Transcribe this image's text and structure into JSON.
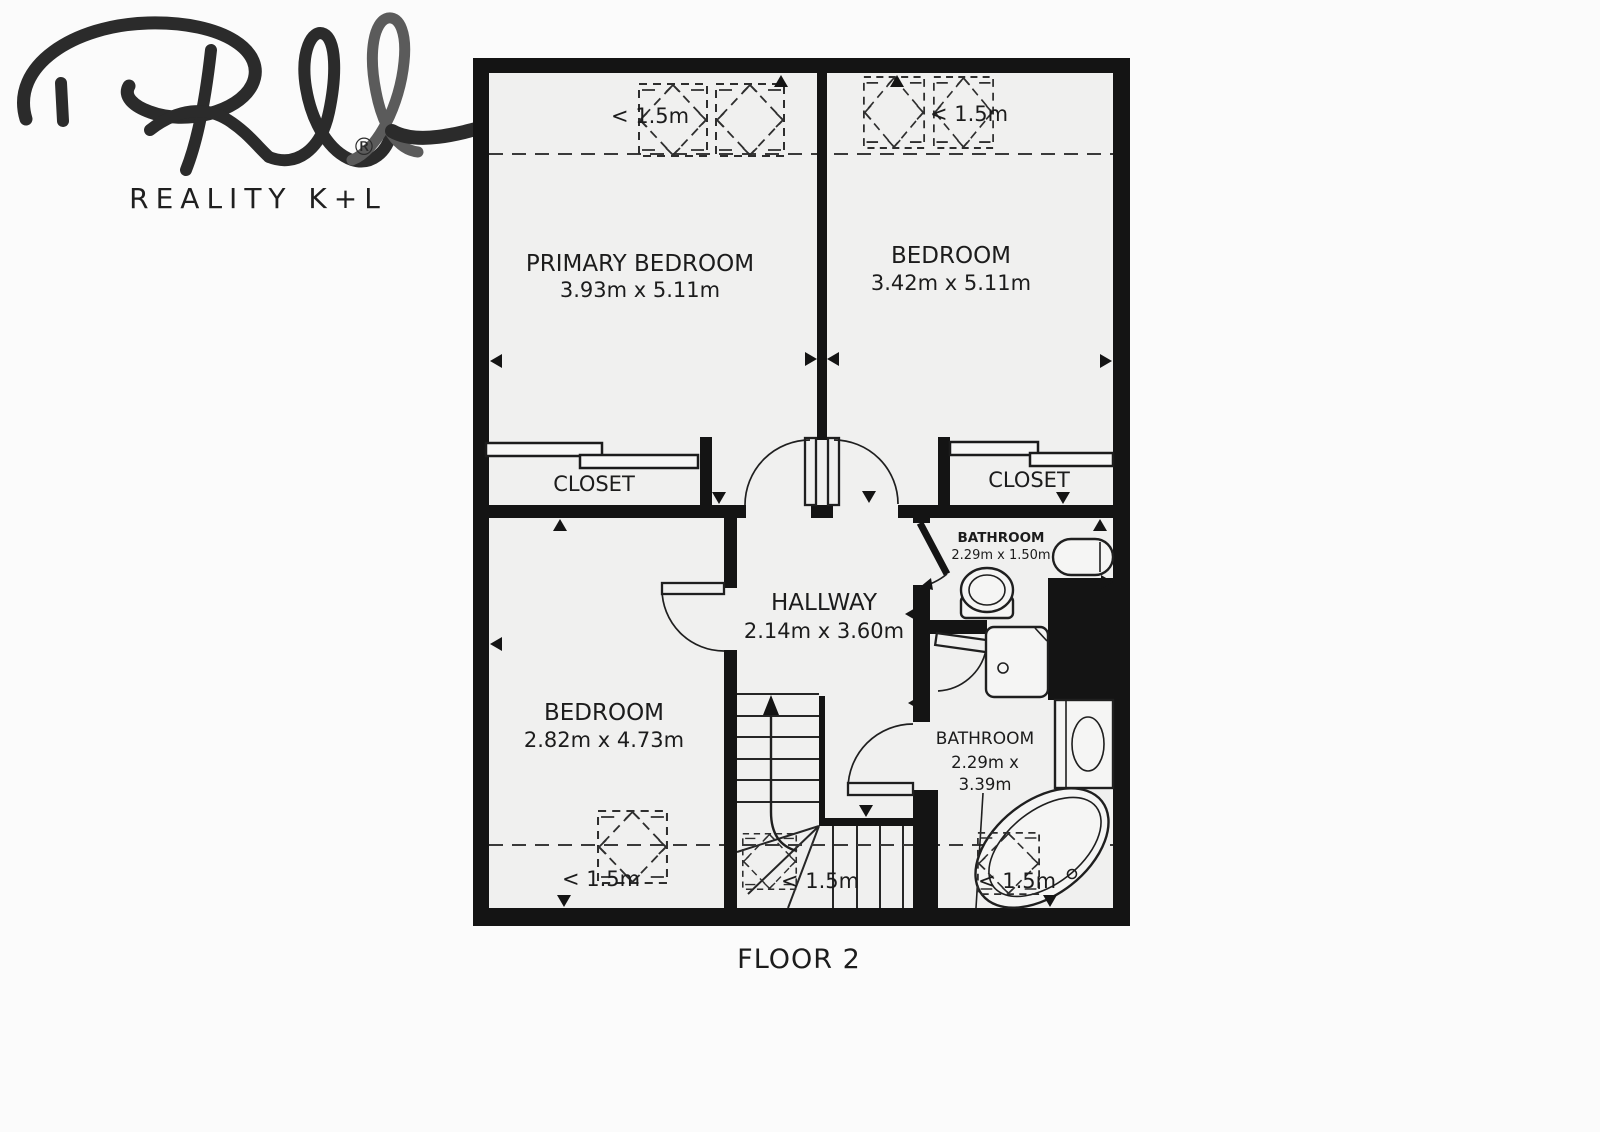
{
  "logo": {
    "brand": "REALITY K+L",
    "registered": "®"
  },
  "plan": {
    "floor_label": "FLOOR 2",
    "low_ceiling": "< 1.5m"
  },
  "rooms": {
    "primary_bedroom": {
      "name": "PRIMARY BEDROOM",
      "dims": "3.93m x 5.11m"
    },
    "bedroom_top": {
      "name": "BEDROOM",
      "dims": "3.42m x 5.11m"
    },
    "bedroom_bottom": {
      "name": "BEDROOM",
      "dims": "2.82m x 4.73m"
    },
    "hallway": {
      "name": "HALLWAY",
      "dims": "2.14m x 3.60m"
    },
    "bathroom_top": {
      "name": "BATHROOM",
      "dims": "2.29m x 1.50m"
    },
    "bathroom_bottom": {
      "name": "BATHROOM",
      "dims_line1": "2.29m x",
      "dims_line2": "3.39m"
    },
    "closet_left": {
      "name": "CLOSET"
    },
    "closet_right": {
      "name": "CLOSET"
    }
  },
  "icons": {
    "toilet-icon": "ellipse-on-base shape",
    "sink-icon": "stadium shape",
    "shower-icon": "square with drain circle",
    "washing-machine-icon": "square with drum oval",
    "bathtub-icon": "rotated oval in corner platform",
    "skylight-icon": "dashed square with dashed diamond",
    "stairs-up-arrow-icon": "curved shaft with triangle head",
    "door-swing-icon": "leaf with quarter-circle arc",
    "logo-signature-icon": "handwritten RKL scribble"
  },
  "colors": {
    "wall": "#141414",
    "floor": "#f0f0ef",
    "line": "#262626",
    "dashed": "#3a3a3a",
    "background": "#fbfbfb",
    "text": "#1c1c1c",
    "logo_dark": "#2b2b2b",
    "logo_gray": "#5b5b5b"
  }
}
